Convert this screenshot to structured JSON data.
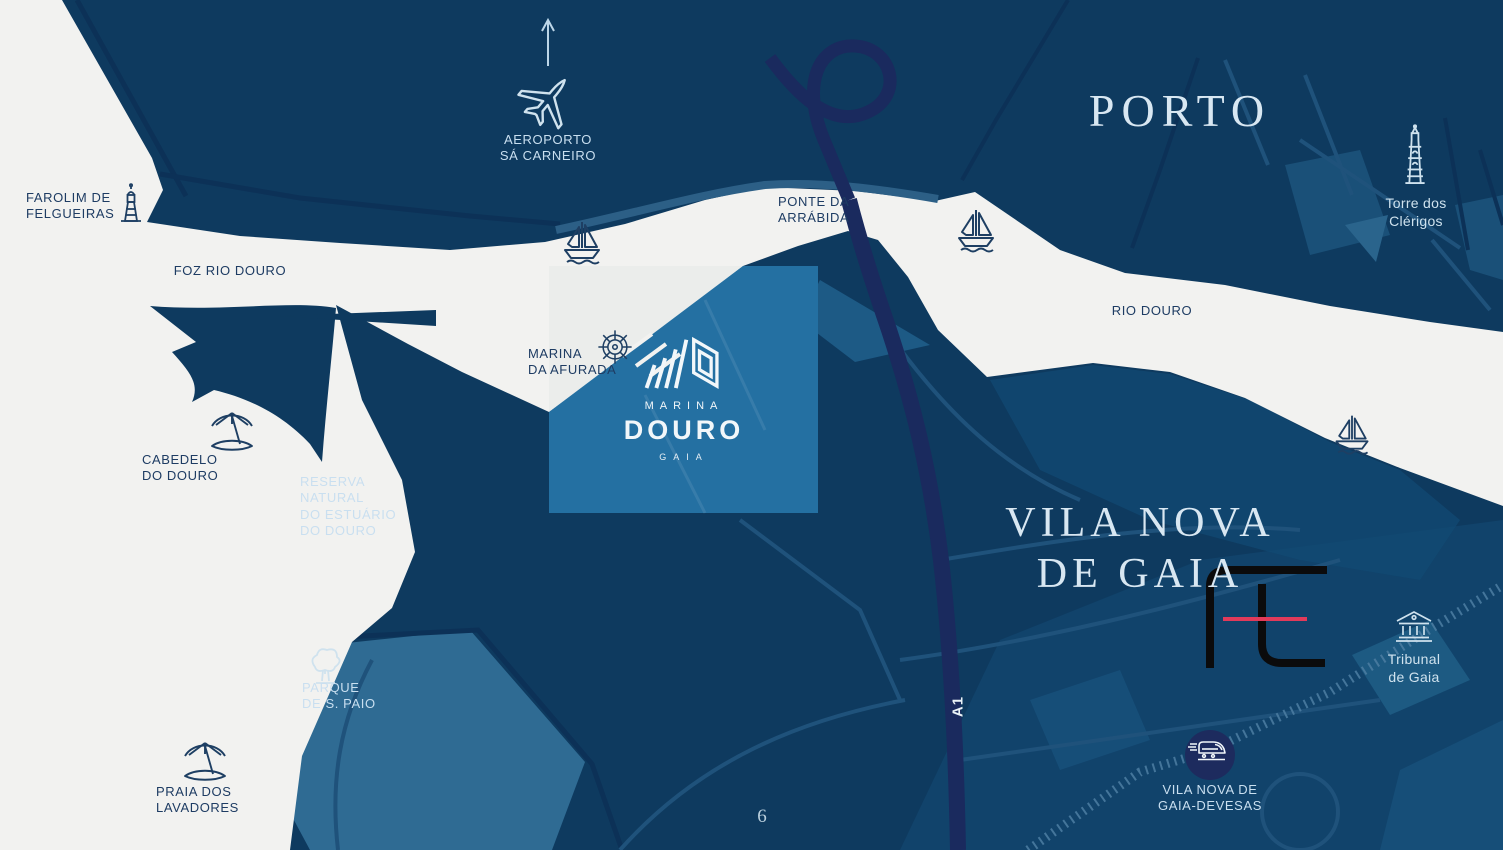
{
  "page": {
    "page_number": "6"
  },
  "regions": {
    "porto": "PORTO",
    "vila_nova_l1": "VILA NOVA",
    "vila_nova_l2": "DE GAIA"
  },
  "water_labels": {
    "foz": "FOZ RIO DOURO",
    "rio_douro": "RIO DOURO"
  },
  "pois": {
    "aeroporto": {
      "l1": "AEROPORTO",
      "l2": "SÁ CARNEIRO",
      "icon": "airplane-icon"
    },
    "farolim": {
      "l1": "FAROLIM DE",
      "l2": "FELGUEIRAS",
      "icon": "lighthouse-icon"
    },
    "ponte": {
      "l1": "PONTE DA",
      "l2": "ARRÁBIDA"
    },
    "torre": {
      "l1": "Torre dos",
      "l2": "Clérigos",
      "icon": "tower-icon"
    },
    "marina_afurada": {
      "l1": "MARINA",
      "l2": "DA AFURADA",
      "icon": "ship-wheel-icon"
    },
    "cabedelo": {
      "l1": "CABEDELO",
      "l2": "DO DOURO",
      "icon": "beach-umbrella-icon"
    },
    "reserva": {
      "l1": "RESERVA",
      "l2": "NATURAL",
      "l3": "DO ESTUÁRIO",
      "l4": "DO DOURO"
    },
    "parque": {
      "l1": "PARQUE",
      "l2": "DE S. PAIO",
      "icon": "tree-icon"
    },
    "praia": {
      "l1": "PRAIA DOS",
      "l2": "LAVADORES",
      "icon": "beach-umbrella-icon"
    },
    "tribunal": {
      "l1": "Tribunal",
      "l2": "de Gaia",
      "icon": "courthouse-icon"
    },
    "devesas": {
      "l1": "VILA NOVA DE",
      "l2": "GAIA-DEVESAS",
      "icon": "train-icon"
    },
    "a1": {
      "label": "A1"
    }
  },
  "logo": {
    "brand_l1": "MARINA",
    "brand_l2": "DOURO",
    "brand_l3": "GAIA",
    "icon": "marina-douro-mark"
  },
  "icons": {
    "airplane-icon": "outline airplane with up arrow",
    "lighthouse-icon": "outline lighthouse",
    "sailboat-icon": "outline sailboat on waves",
    "ship-wheel-icon": "outline ship helm wheel",
    "beach-umbrella-icon": "outline tilted beach umbrella on islet",
    "tree-icon": "outline park tree",
    "tower-icon": "outline Clerigos tower",
    "courthouse-icon": "outline columned courthouse",
    "train-icon": "white train in navy circle",
    "marina-douro-mark": "white slanted bars and angular D",
    "watermark-logo": "black ft monogram with red strike"
  },
  "colors": {
    "land": "#0e3a5f",
    "water": "#f2f2f0",
    "highway_a1": "#1a2a5e",
    "highlight_square_land": "#2470a2",
    "shore_band": "#2c5f86",
    "label_on_land": "#c9dff0",
    "label_on_water": "#1e3c63",
    "watermark_black": "#0b0b0c",
    "watermark_red": "#e23a5a"
  }
}
